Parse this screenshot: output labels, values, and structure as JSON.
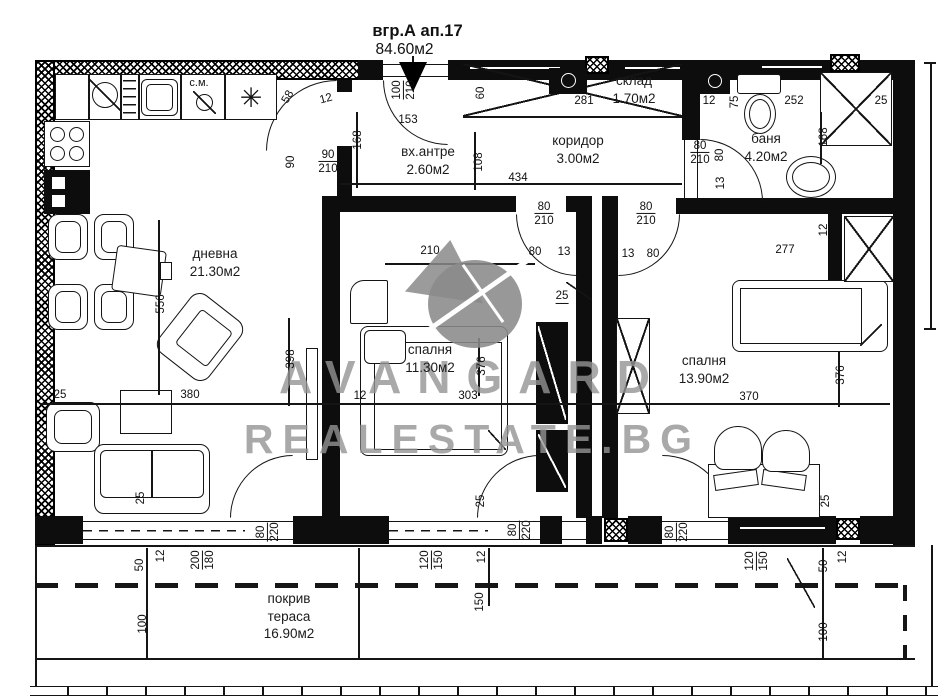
{
  "title": {
    "building": "вгр.А ап.17",
    "area": "84.60м2"
  },
  "watermark": {
    "line1": "AVANGARD",
    "line2": "REALESTATE.BG"
  },
  "rooms": [
    {
      "name": "дневна",
      "area": "21.30м2"
    },
    {
      "name": "вх.антре",
      "area": "2.60м2"
    },
    {
      "name": "коридор",
      "area": "3.00м2"
    },
    {
      "name": "склад",
      "area": "1.70м2"
    },
    {
      "name": "баня",
      "area": "4.20м2"
    },
    {
      "name": "спалня",
      "area": "11.30м2"
    },
    {
      "name": "спалня",
      "area": "13.90м2"
    },
    {
      "name": "покрив тераса",
      "area": "16.90м2"
    }
  ],
  "labels": {
    "washing_machine": "с.м.",
    "freezer_symbol": "✳"
  },
  "colors": {
    "ink": "#111111",
    "watermark_gray": "#949494"
  },
  "dimensions": [
    {
      "t": "100",
      "t2": "210",
      "x": 404,
      "y": 90,
      "r": -90
    },
    {
      "t": "153",
      "x": 408,
      "y": 120,
      "r": 0
    },
    {
      "t": "60",
      "x": 481,
      "y": 93,
      "r": -90
    },
    {
      "t": "281",
      "x": 584,
      "y": 101,
      "r": 0
    },
    {
      "t": "58",
      "x": 288,
      "y": 97,
      "r": -60
    },
    {
      "t": "12",
      "x": 326,
      "y": 99,
      "r": -15
    },
    {
      "t": "168",
      "x": 358,
      "y": 140,
      "r": -90
    },
    {
      "t": "90",
      "t2": "210",
      "x": 328,
      "y": 162,
      "r": 0
    },
    {
      "t": "90",
      "x": 291,
      "y": 162,
      "r": -90
    },
    {
      "t": "108",
      "x": 479,
      "y": 162,
      "r": -90
    },
    {
      "t": "434",
      "x": 518,
      "y": 178,
      "r": 0
    },
    {
      "t": "12",
      "x": 709,
      "y": 101,
      "r": 0
    },
    {
      "t": "75",
      "x": 735,
      "y": 102,
      "r": -90
    },
    {
      "t": "252",
      "x": 794,
      "y": 101,
      "r": 0
    },
    {
      "t": "25",
      "x": 881,
      "y": 101,
      "r": 0
    },
    {
      "t": "80",
      "t2": "210",
      "x": 700,
      "y": 153,
      "r": 0
    },
    {
      "t": "80",
      "x": 720,
      "y": 155,
      "r": -90
    },
    {
      "t": "13",
      "x": 721,
      "y": 183,
      "r": -90
    },
    {
      "t": "168",
      "x": 824,
      "y": 137,
      "r": -90
    },
    {
      "t": "12",
      "x": 824,
      "y": 230,
      "r": -90
    },
    {
      "t": "80",
      "t2": "210",
      "x": 544,
      "y": 214,
      "r": 0
    },
    {
      "t": "80",
      "t2": "210",
      "x": 646,
      "y": 214,
      "r": 0
    },
    {
      "t": "80",
      "x": 535,
      "y": 252,
      "r": 0
    },
    {
      "t": "13",
      "x": 564,
      "y": 252,
      "r": 0
    },
    {
      "t": "13",
      "x": 628,
      "y": 254,
      "r": 0
    },
    {
      "t": "80",
      "x": 653,
      "y": 254,
      "r": 0
    },
    {
      "t": "25",
      "x": 562,
      "y": 297,
      "r": 0,
      "u": true
    },
    {
      "t": "210",
      "x": 430,
      "y": 251,
      "r": 0
    },
    {
      "t": "277",
      "x": 785,
      "y": 250,
      "r": 0
    },
    {
      "t": "556",
      "x": 161,
      "y": 304,
      "r": -90
    },
    {
      "t": "398",
      "x": 291,
      "y": 359,
      "r": -90
    },
    {
      "t": "380",
      "x": 190,
      "y": 395,
      "r": 0
    },
    {
      "t": "25",
      "x": 60,
      "y": 395,
      "r": 0
    },
    {
      "t": "376",
      "x": 482,
      "y": 366,
      "r": -90
    },
    {
      "t": "303",
      "x": 468,
      "y": 396,
      "r": 0
    },
    {
      "t": "12",
      "x": 360,
      "y": 396,
      "r": 0
    },
    {
      "t": "370",
      "x": 749,
      "y": 397,
      "r": 0
    },
    {
      "t": "376",
      "x": 841,
      "y": 375,
      "r": -90
    },
    {
      "t": "25",
      "x": 141,
      "y": 498,
      "r": -90
    },
    {
      "t": "80",
      "t2": "220",
      "x": 268,
      "y": 532,
      "r": -90
    },
    {
      "t": "50",
      "x": 140,
      "y": 565,
      "r": -90
    },
    {
      "t": "12",
      "x": 161,
      "y": 556,
      "r": -90
    },
    {
      "t": "200",
      "t2": "180",
      "x": 203,
      "y": 560,
      "r": -90
    },
    {
      "t": "100",
      "x": 143,
      "y": 624,
      "r": -90
    },
    {
      "t": "25",
      "x": 481,
      "y": 501,
      "r": -90
    },
    {
      "t": "80",
      "t2": "220",
      "x": 520,
      "y": 530,
      "r": -90
    },
    {
      "t": "12",
      "x": 482,
      "y": 557,
      "r": -90
    },
    {
      "t": "120",
      "t2": "150",
      "x": 432,
      "y": 560,
      "r": -90
    },
    {
      "t": "150",
      "x": 480,
      "y": 602,
      "r": -90
    },
    {
      "t": "25",
      "x": 826,
      "y": 501,
      "r": -90
    },
    {
      "t": "80",
      "t2": "220",
      "x": 677,
      "y": 532,
      "r": -90
    },
    {
      "t": "120",
      "t2": "150",
      "x": 757,
      "y": 561,
      "r": -90
    },
    {
      "t": "50",
      "x": 824,
      "y": 566,
      "r": -90
    },
    {
      "t": "12",
      "x": 843,
      "y": 557,
      "r": -90
    },
    {
      "t": "100",
      "x": 824,
      "y": 632,
      "r": -90
    }
  ]
}
